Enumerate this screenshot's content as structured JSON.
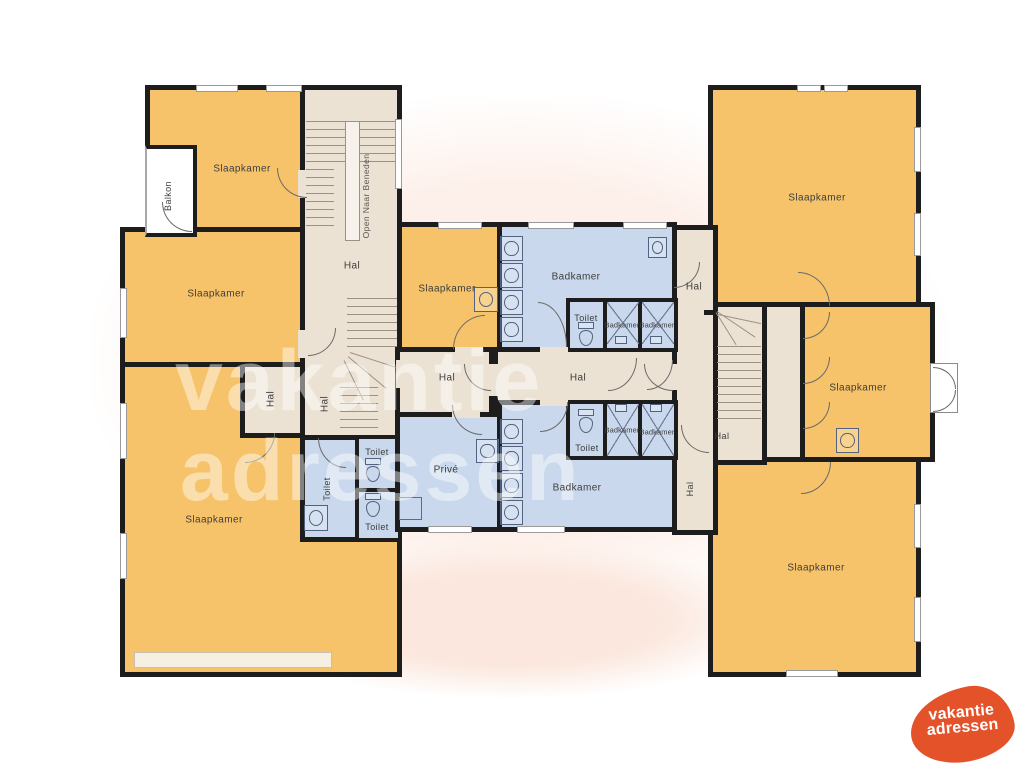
{
  "page": {
    "background": "#ffffff"
  },
  "colors": {
    "bedroom": "#f6c36a",
    "bathroom": "#c9d8ec",
    "hallway": "#ece2d4",
    "wall": "#1d1d1d",
    "balcony": "#ffffff",
    "logo_blob": "#e4522a"
  },
  "rooms": {
    "slaapkamer_top_left": "Slaapkamer",
    "slaapkamer_left": "Slaapkamer",
    "slaapkamer_bottom_left": "Slaapkamer",
    "slaapkamer_middle": "Slaapkamer",
    "slaapkamer_top_right": "Slaapkamer",
    "slaapkamer_mid_right": "Slaapkamer",
    "slaapkamer_bottom_right": "Slaapkamer",
    "balkon": "Balkon",
    "hal_stairwell": "Hal",
    "open_naar_beneden": "Open Naar Beneden",
    "hal_left_upper": "Hal",
    "hal_left_lower": "Hal",
    "hal_top_right": "Hal",
    "hal_center_west": "Hal",
    "hal_center_east": "Hal",
    "hal_right_stair": "Hal",
    "hal_corridor": "Hal",
    "toilet_left": "Toilet",
    "toilet_left_top": "Toilet",
    "toilet_left_bottom": "Toilet",
    "toilet_top_center": "Toilet",
    "toilet_bottom_center": "Toilet",
    "badkamer_top": "Badkamer",
    "badkamer_top_shower_1": "Badkamer",
    "badkamer_top_shower_2": "Badkamer",
    "badkamer_bottom": "Badkamer",
    "badkamer_bottom_shower_1": "Badkamer",
    "badkamer_bottom_shower_2": "Badkamer",
    "prive": "Privé"
  },
  "watermark": {
    "line1": "vakantie",
    "line2": "adressen"
  },
  "logo": {
    "line1": "vakantie",
    "line2": "adressen"
  }
}
